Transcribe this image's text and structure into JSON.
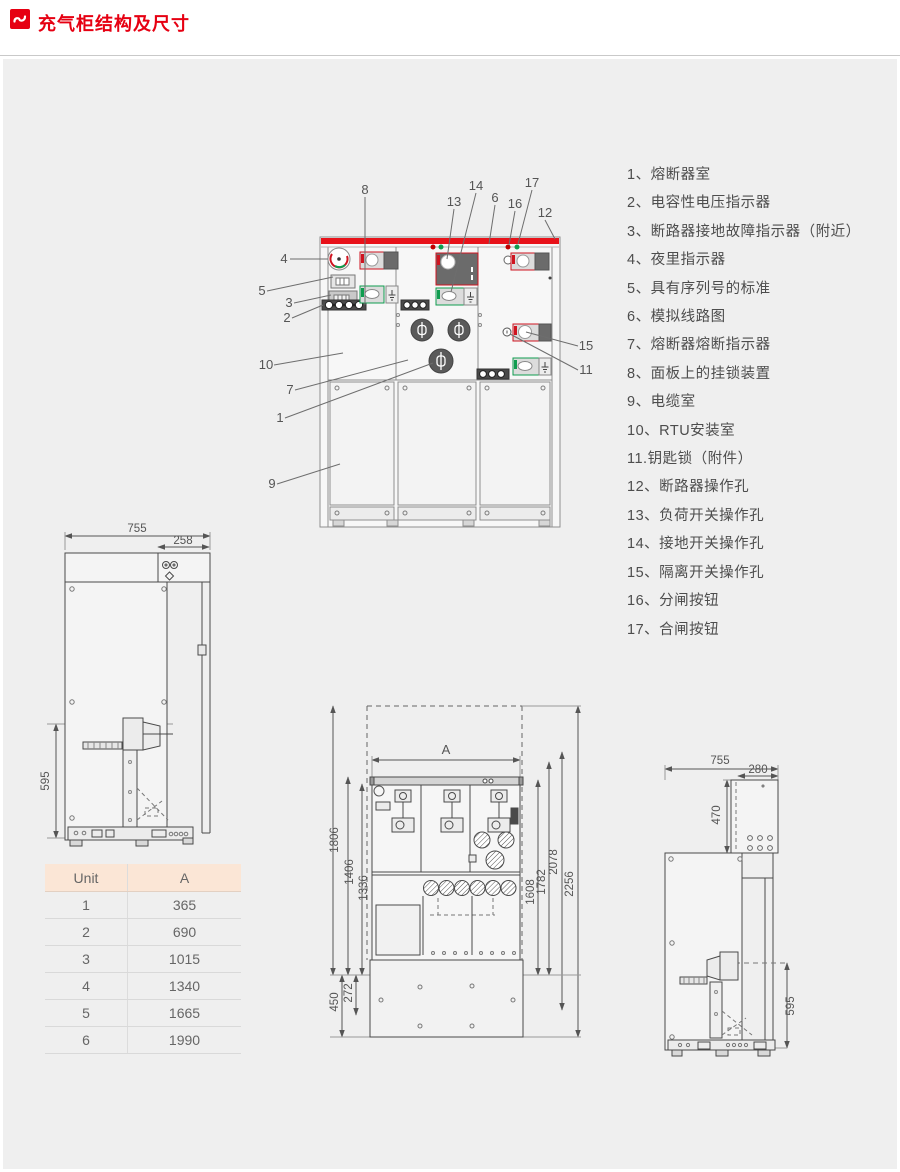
{
  "header": {
    "title": "充气柜结构及尺寸"
  },
  "colors": {
    "accent_red": "#e60012",
    "drawing_red": "#e8121a",
    "drawing_green": "#0f9d4f",
    "table_header_bg": "#fbe6d6"
  },
  "legend": {
    "items": [
      "1、熔断器室",
      "2、电容性电压指示器",
      "3、断路器接地故障指示器（附近）",
      "4、夜里指示器",
      "5、具有序列号的标准",
      "6、模拟线路图",
      "7、熔断器熔断指示器",
      "8、面板上的挂锁装置",
      "9、电缆室",
      "10、RTU安装室",
      "11.钥匙锁（附件）",
      "12、断路器操作孔",
      "13、负荷开关操作孔",
      "14、接地开关操作孔",
      "15、隔离开关操作孔",
      "16、分闸按钮",
      "17、合闸按钮"
    ]
  },
  "main_view": {
    "callouts": {
      "n1": "1",
      "n2": "2",
      "n3": "3",
      "n4": "4",
      "n5": "5",
      "n6": "6",
      "n7": "7",
      "n8": "8",
      "n9": "9",
      "n10": "10",
      "n11": "11",
      "n12": "12",
      "n13": "13",
      "n14": "14",
      "n15": "15",
      "n16": "16",
      "n17": "17"
    }
  },
  "side_view_left": {
    "dim_width": "755",
    "dim_top_width": "258",
    "dim_top_height": "124",
    "dim_height": "595"
  },
  "front_bottom_view": {
    "dim_a": "A",
    "dim_1806": "1806",
    "dim_1406": "1406",
    "dim_1336": "1336",
    "dim_450": "450",
    "dim_272": "272",
    "dim_1608": "1608",
    "dim_1782": "1782",
    "dim_2078": "2078",
    "dim_2256": "2256"
  },
  "side_view_right": {
    "dim_width": "755",
    "dim_top_width": "280",
    "dim_top_height": "470",
    "dim_height": "595"
  },
  "dimension_table": {
    "headers": [
      "Unit",
      "A"
    ],
    "rows": [
      [
        "1",
        "365"
      ],
      [
        "2",
        "690"
      ],
      [
        "3",
        "1015"
      ],
      [
        "4",
        "1340"
      ],
      [
        "5",
        "1665"
      ],
      [
        "6",
        "1990"
      ]
    ]
  }
}
